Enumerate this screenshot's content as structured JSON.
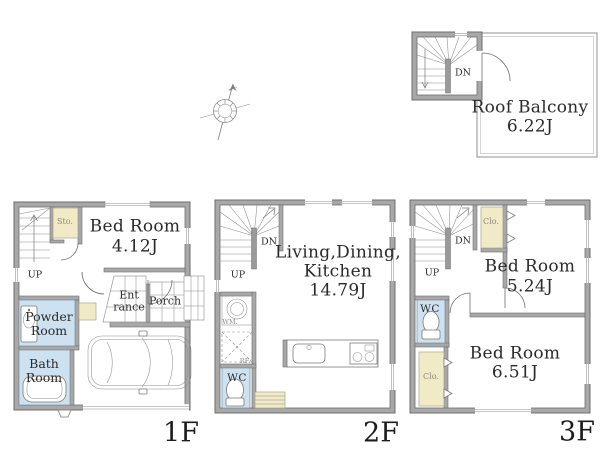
{
  "palette": {
    "bg": "#ffffff",
    "wall": "#a8a8a8",
    "wall_edge": "#6e6e6e",
    "water": "#cde1f0",
    "storage": "#f1eac6",
    "line": "#6f6f6f",
    "text": "#2a2a2a",
    "muted": "#8f897a"
  },
  "icons": {
    "compass": "compass-rose-north-arrow",
    "car": "car-top-view",
    "bathtub": "bathtub",
    "toilet": "toilet",
    "washer": "washing-machine",
    "sink": "kitchen-sink",
    "stove": "gas-stove"
  },
  "floors": {
    "f1": {
      "floor_label": "1F",
      "bedroom_name": "Bed Room",
      "bedroom_size": "4.12J",
      "storage_label": "Sto.",
      "up_label": "UP",
      "entrance_line1": "Ent",
      "entrance_line2": "rance",
      "porch_label": "Porch",
      "powder_line1": "Powder",
      "powder_line2": "Room",
      "bath_line1": "Bath",
      "bath_line2": "Room"
    },
    "f2": {
      "floor_label": "2F",
      "ldk_line1": "Living,Dining,",
      "ldk_line2": "Kitchen",
      "ldk_size": "14.79J",
      "dn_label": "DN",
      "up_label": "UP",
      "washer_label": "WM.",
      "fridge_label": "RF.",
      "wc_label": "WC"
    },
    "f3": {
      "floor_label": "3F",
      "dn_label": "DN",
      "up_label": "UP",
      "closet_top_label": "Clo.",
      "closet_bottom_label": "Clo.",
      "wc_label": "WC",
      "bedroom1_name": "Bed Room",
      "bedroom1_size": "5.24J",
      "bedroom2_name": "Bed Room",
      "bedroom2_size": "6.51J"
    },
    "roof": {
      "dn_label": "DN",
      "balcony_name": "Roof Balcony",
      "balcony_size": "6.22J"
    }
  }
}
